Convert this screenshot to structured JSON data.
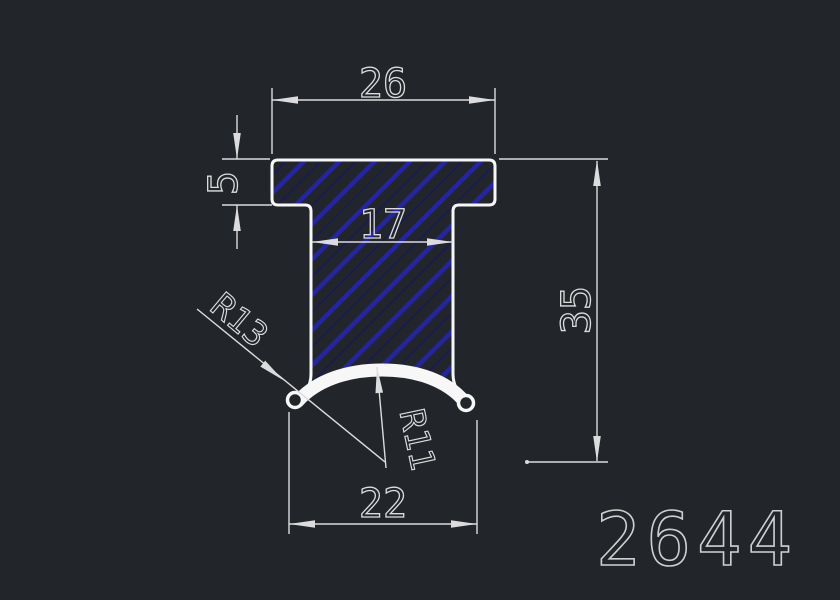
{
  "colors": {
    "bg": "#22262b",
    "line": "#f7f7f7",
    "dim": "#dcdcdc",
    "text": "#dcdcdc",
    "hatch_bold": "#2424a4",
    "hatch_faint": "#17175f",
    "part_text": "#cfcfcf",
    "lip_right_fill": "#1f1f72"
  },
  "drawing": {
    "part_number": "2644",
    "dimensions": {
      "top_width": "26",
      "flange_thickness": "5",
      "stem_width": "17",
      "total_height": "35",
      "bottom_width": "22",
      "outer_radius": "R13",
      "inner_radius": "R11"
    }
  }
}
